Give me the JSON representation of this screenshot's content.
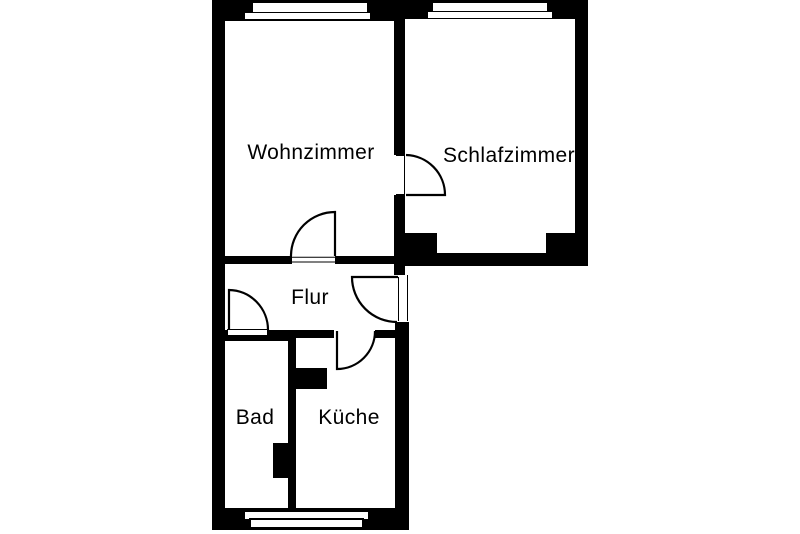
{
  "floorplan": {
    "background_color": "#ffffff",
    "line_color": "#000000",
    "rooms": [
      {
        "name": "Wohnzimmer"
      },
      {
        "name": "Schlafzimmer"
      },
      {
        "name": "Flur"
      },
      {
        "name": "Bad"
      },
      {
        "name": "Küche"
      }
    ],
    "doors": [
      "schlafzimmer-door",
      "wohnzimmer-flur-door",
      "apartment-entrance-door",
      "bad-door",
      "kueche-door"
    ],
    "windows": [
      "wohnzimmer-window",
      "schlafzimmer-window",
      "bad-kueche-window"
    ],
    "features": [
      "chimney-shaft-kueche",
      "chimney-shaft-bad"
    ]
  }
}
